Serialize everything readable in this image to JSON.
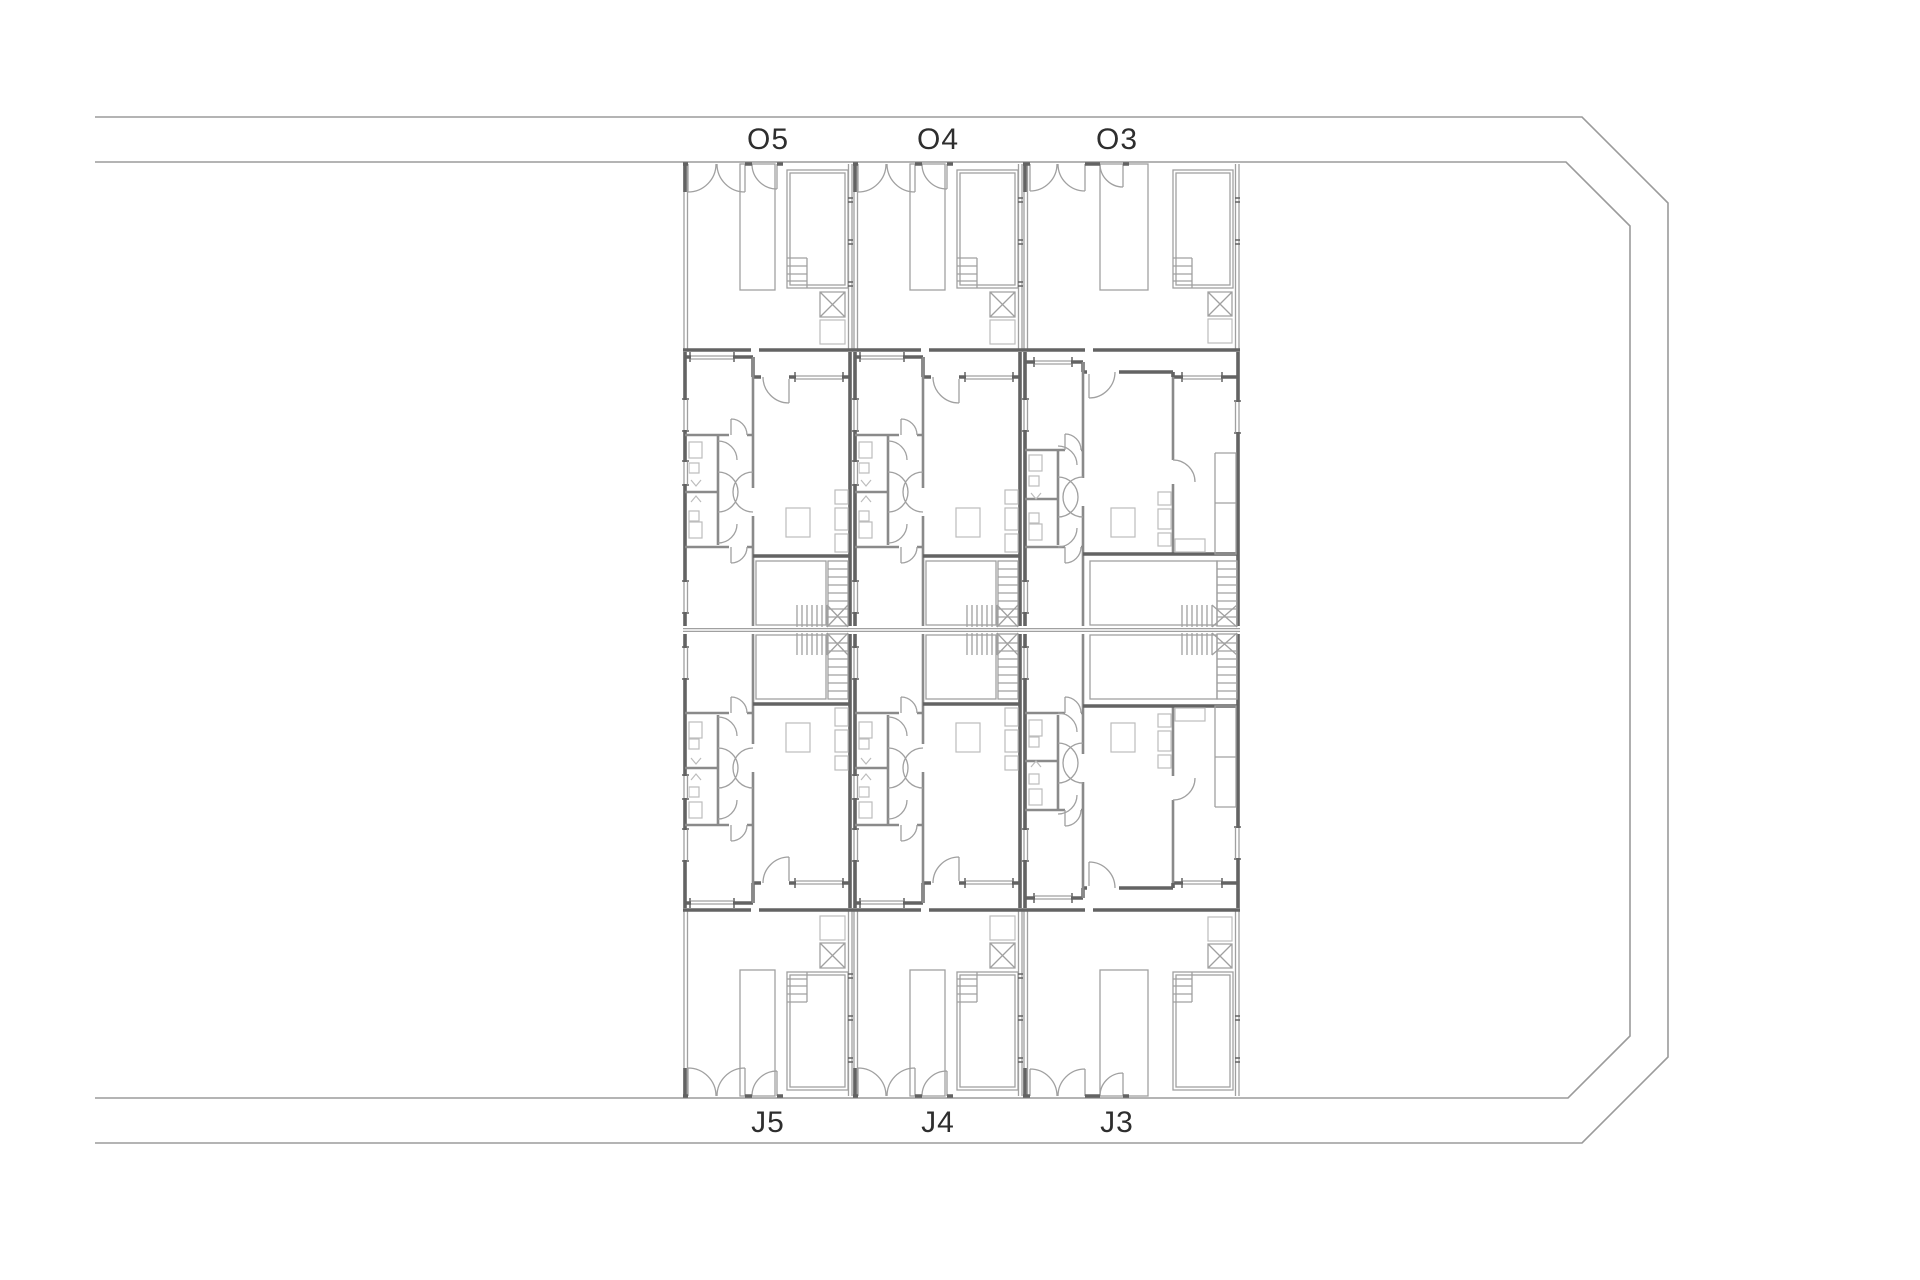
{
  "drawing": {
    "title": "Townhouse site floor plan",
    "site": {
      "boundary_style": "double perimeter line with chamfered right corners, open at left edge"
    },
    "units": {
      "top_row": [
        {
          "label": "O5"
        },
        {
          "label": "O4"
        },
        {
          "label": "O3"
        }
      ],
      "bottom_row": [
        {
          "label": "J5"
        },
        {
          "label": "J4"
        },
        {
          "label": "J3"
        }
      ]
    },
    "features_per_unit": [
      "entry terrace with double patio doors",
      "plunge pool with corner steps",
      "planter strip",
      "skylight box (crossed square)",
      "two bedrooms",
      "two bathrooms",
      "hall with double swing doors",
      "living room with table",
      "kitchen strip",
      "inner patio",
      "L-shaped stair"
    ],
    "colors": {
      "background": "#ffffff",
      "boundary": "#9b9b9b",
      "wall": "#636363",
      "partition": "#8a8a8a",
      "detail": "#a0a0a0",
      "fixture": "#bcbcbc",
      "label": "#2e2e2e"
    }
  }
}
